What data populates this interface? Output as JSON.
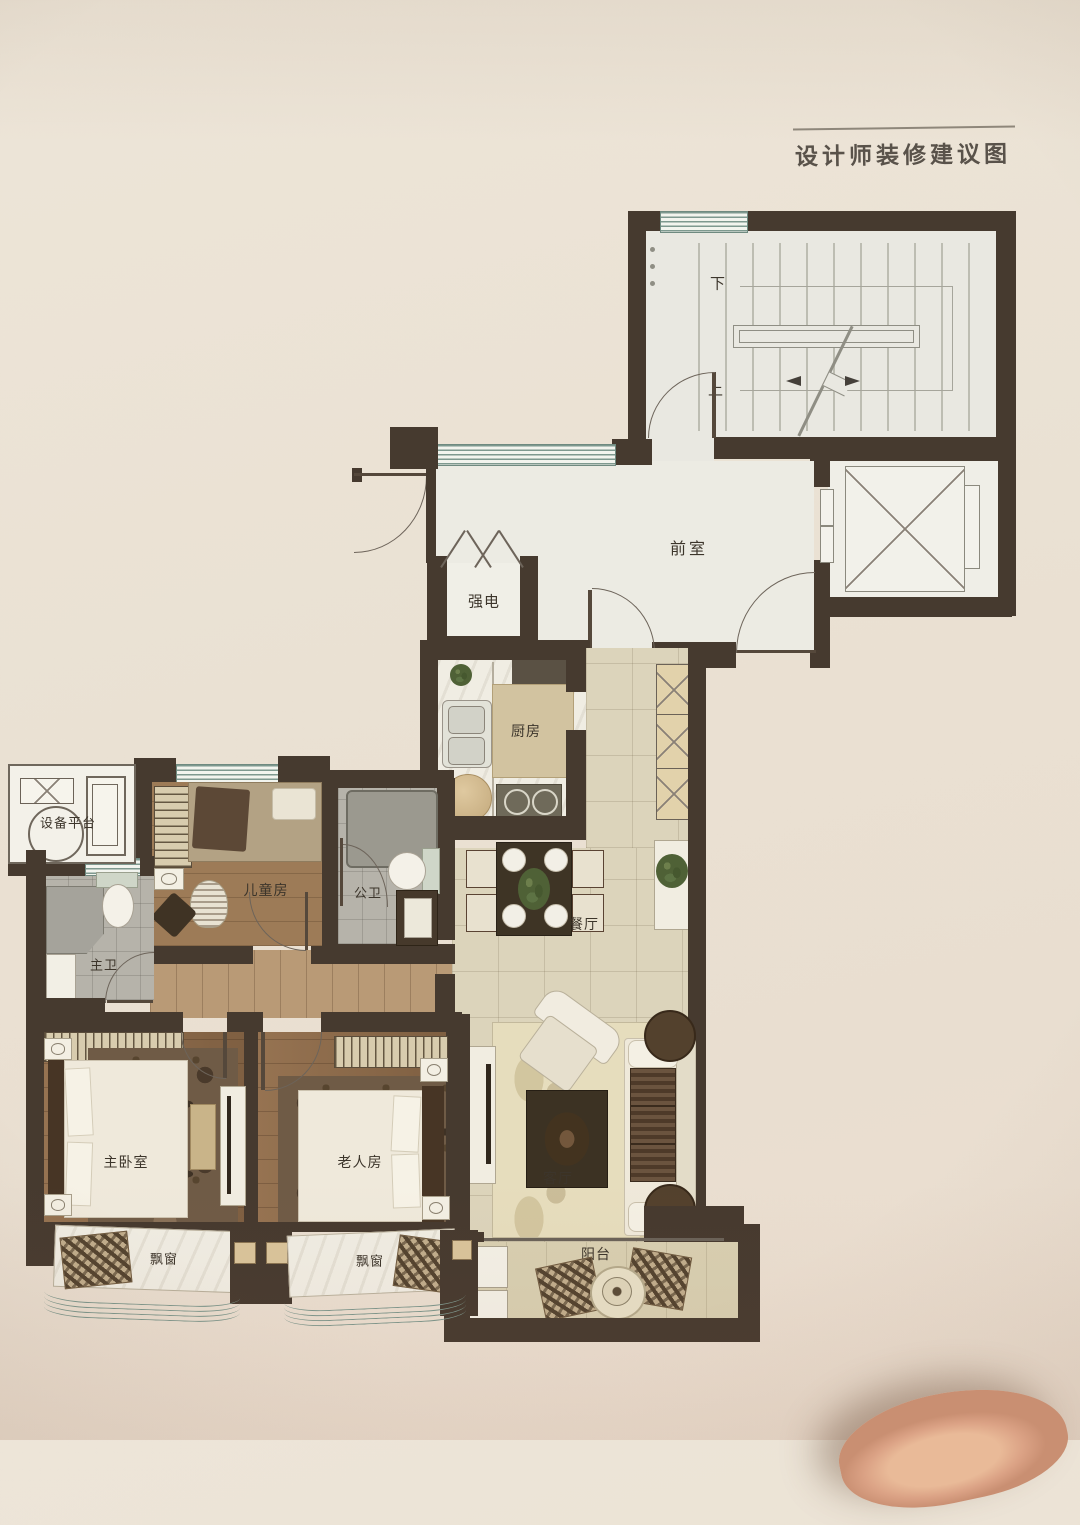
{
  "title": "设计师装修建议图",
  "plan": {
    "rooms": [
      {
        "id": "vestibule",
        "label": "前室"
      },
      {
        "id": "electrical-closet",
        "label": "强电"
      },
      {
        "id": "kitchen",
        "label": "厨房"
      },
      {
        "id": "dining-room",
        "label": "餐厅"
      },
      {
        "id": "living-room",
        "label": "客厅"
      },
      {
        "id": "master-bedroom",
        "label": "主卧室"
      },
      {
        "id": "elderly-room",
        "label": "老人房"
      },
      {
        "id": "children-room",
        "label": "儿童房"
      },
      {
        "id": "public-bathroom",
        "label": "公卫"
      },
      {
        "id": "master-bathroom",
        "label": "主卫"
      },
      {
        "id": "equipment-platform",
        "label": "设备平台"
      },
      {
        "id": "balcony",
        "label": "阳台"
      },
      {
        "id": "bay-window-left",
        "label": "飘窗"
      },
      {
        "id": "bay-window-right",
        "label": "飘窗"
      }
    ],
    "stairs": {
      "down_label": "下",
      "up_label": "上"
    }
  },
  "colors": {
    "paper": "#eae1d3",
    "wall": "#463a2f",
    "wood_floor": "#8d6a49",
    "tile_floor": "#dcd4bb",
    "window_teal": "#7e998f",
    "marble": "#f0ede3",
    "label_text": "#3c352b"
  }
}
